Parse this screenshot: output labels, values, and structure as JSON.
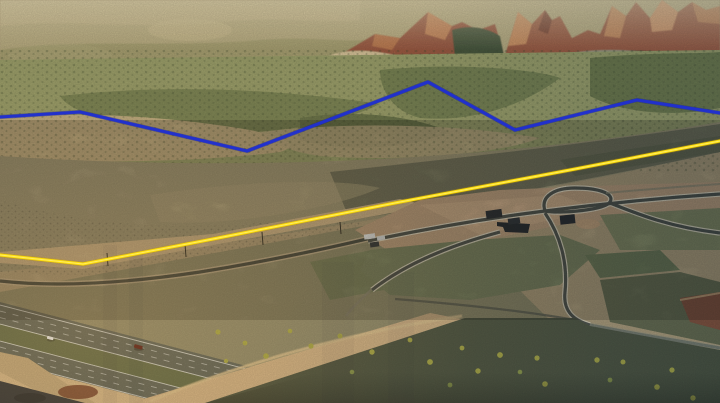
{
  "scene": {
    "kind": "oblique aerial drone photograph",
    "setting": "high-desert valley at golden hour: red-rock mountain peaks behind juniper foothills, open sagebrush flats, a rural subdivision under construction, a two-lane frontage road, and a divided interstate freeway crossing the lower-left corner",
    "time_of_day": "golden hour / early evening, warm light from lower left",
    "palette": {
      "haze": "#c1b489",
      "red_rock": "#a05e45",
      "red_rock_sunlit": "#cf9162",
      "conifer": "#4b593f",
      "juniper_slope": "#9ba16c",
      "open_flat": "#c3b084",
      "sage_flat": "#a09878",
      "sage_dark": "#72735b",
      "sunlit_dirt": "#d3ba8e",
      "subdivision_dirt": "#c2a381",
      "field_green": "#7a8460",
      "road_asphalt": "#43483f",
      "road_curb": "#e6dfc9",
      "freeway_asphalt": "#5b635a",
      "median_grass": "#5e6a48",
      "lane_line": "#dfe3df",
      "embankment": "#d2b488",
      "rock_shadow": "#2d3237",
      "red_rocks_cut": "#74432e",
      "scrub_hill": "#49523f",
      "rabbitbrush": "#a9aa45"
    }
  },
  "annotations": {
    "boundary_blue": {
      "label": "rear parcel boundary line (blue)",
      "color": "#2030d0",
      "points": "0,117 80,112 247,151 428,82 515,130 576,115 637,100 720,113"
    },
    "boundary_yellow": {
      "label": "front parcel boundary line along road (yellow)",
      "color": "#ffdf0a",
      "points": "0,255 83,264 213,239 400,202 570,170 720,141"
    }
  },
  "freeway": {
    "description": "divided freeway, two carriageways with grass median, running upper-left to lower-right",
    "vehicles": [
      {
        "type": "car",
        "color": "#eef2f4"
      },
      {
        "type": "pickup-truck",
        "color": "#5e1c14"
      },
      {
        "type": "small-vehicle",
        "color": "#e8e8e0"
      }
    ]
  },
  "subdivision": {
    "description": "graded lots, new curbed streets, loop road, a few dark-roofed buildings and white trailers",
    "building_roof_color": "#23282e",
    "trailer_roof_color": "#e8ecec"
  }
}
